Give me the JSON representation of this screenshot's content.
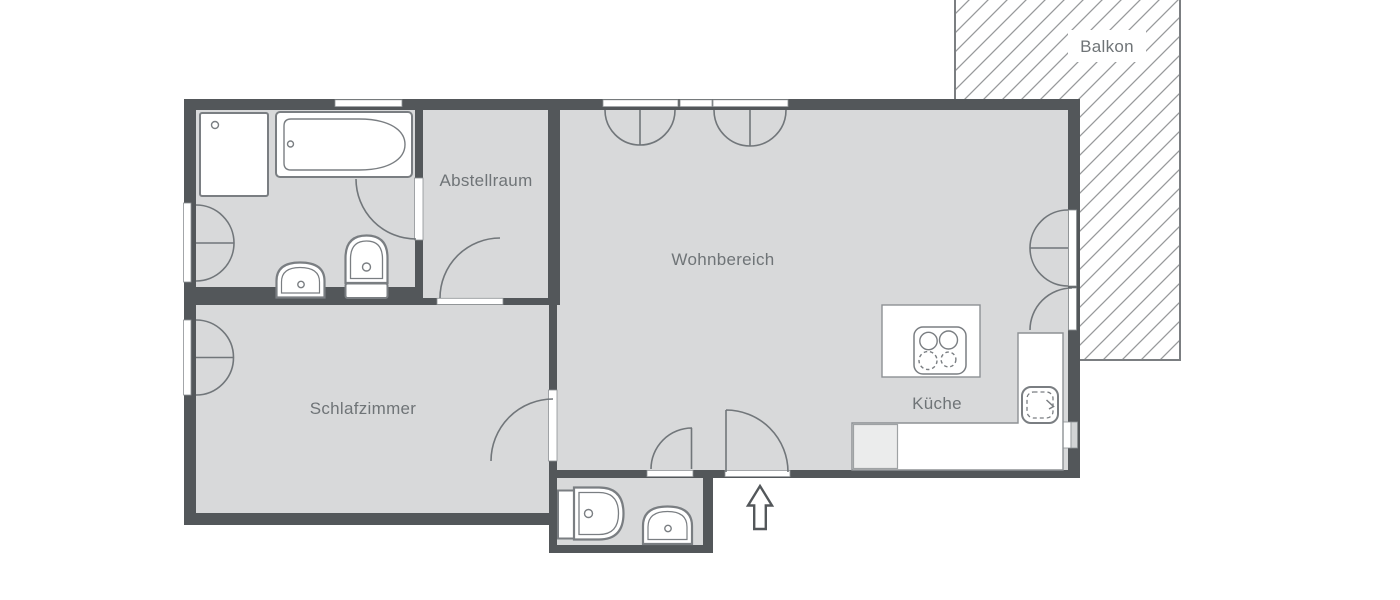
{
  "plan": {
    "type": "apartment-floorplan",
    "rooms": [
      {
        "id": "balkon",
        "label": "Balkon"
      },
      {
        "id": "abstellraum",
        "label": "Abstellraum"
      },
      {
        "id": "wohnbereich",
        "label": "Wohnbereich"
      },
      {
        "id": "schlafzimmer",
        "label": "Schlafzimmer"
      },
      {
        "id": "kueche",
        "label": "Küche"
      }
    ],
    "fixtures": [
      "shower",
      "bathtub",
      "toilet-bathroom",
      "washbasin-bathroom",
      "toilet-wc",
      "washbasin-wc",
      "kitchen-island",
      "stove-4-burners",
      "kitchen-counter-l-shape",
      "kitchen-sink",
      "dishwasher"
    ],
    "openings": [
      "window-bathroom-left",
      "window-bathroom-top",
      "window-bedroom-left",
      "window-livingroom-top-1",
      "window-livingroom-top-2",
      "window-kitchen-right",
      "balcony-double-door",
      "balcony-single-door",
      "door-bathroom",
      "door-storage",
      "door-bedroom",
      "door-wc",
      "door-entrance"
    ],
    "entrance_marker": "up-arrow",
    "colors": {
      "wall": "#53575a",
      "floor": "#d8d9da",
      "fixture_outline": "#7a7e82",
      "arc_line": "#71767a",
      "label_text": "#6f7477",
      "hatch_line": "#97999b",
      "background": "#ffffff"
    }
  }
}
